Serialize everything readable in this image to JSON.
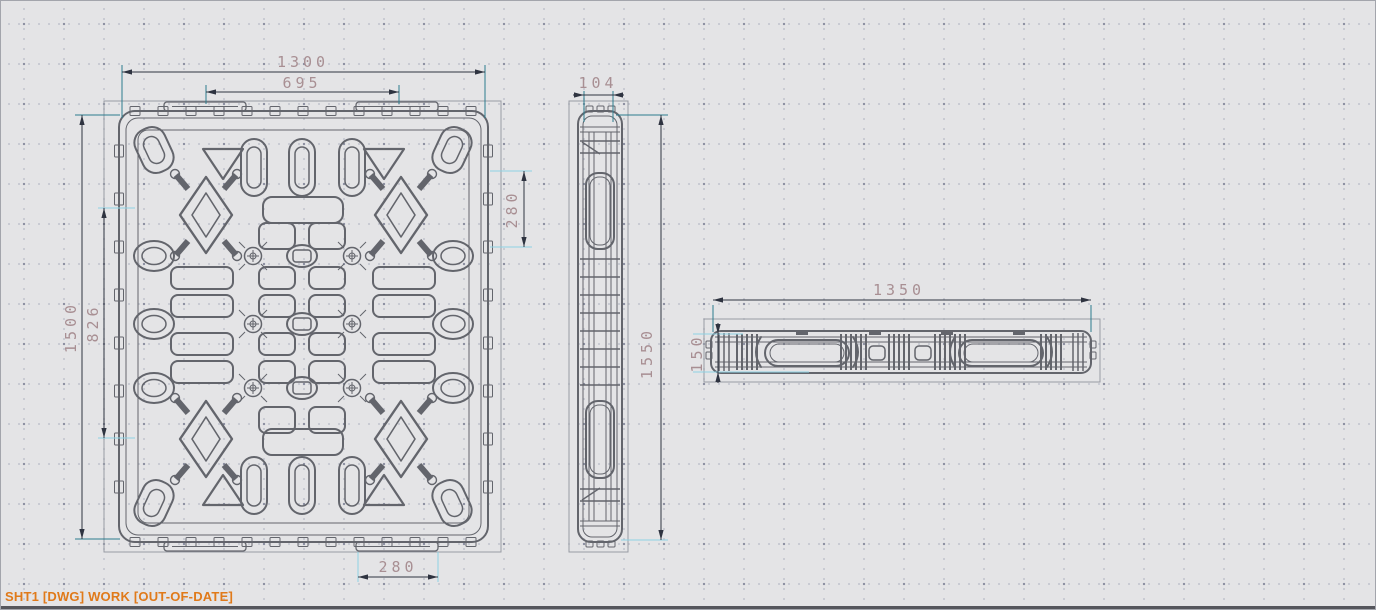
{
  "status_bar": {
    "text": "SHT1 [DWG] WORK [OUT-OF-DATE]"
  },
  "drawing": {
    "type": "pallet-three-view-cad-drawing",
    "views": {
      "plan": {
        "dims": {
          "overall_width": "1300",
          "handle_span": "695",
          "overall_height": "1500",
          "inner_height": "826",
          "side_slot": "280",
          "bottom_handle": "280"
        }
      },
      "side": {
        "dims": {
          "thickness": "104",
          "length": "1550"
        }
      },
      "front": {
        "dims": {
          "length": "1350",
          "height": "150"
        }
      }
    },
    "colors": {
      "background": "#e4e4e6",
      "geometry": "#63656c",
      "view_boundary": "#989ba4",
      "dimension_line": "#2e3340",
      "extension_teal": "#2c7d8f",
      "extension_cyan": "#8ed2e4",
      "dimension_text": "#a88f93",
      "status_text": "#e07a1a"
    }
  }
}
